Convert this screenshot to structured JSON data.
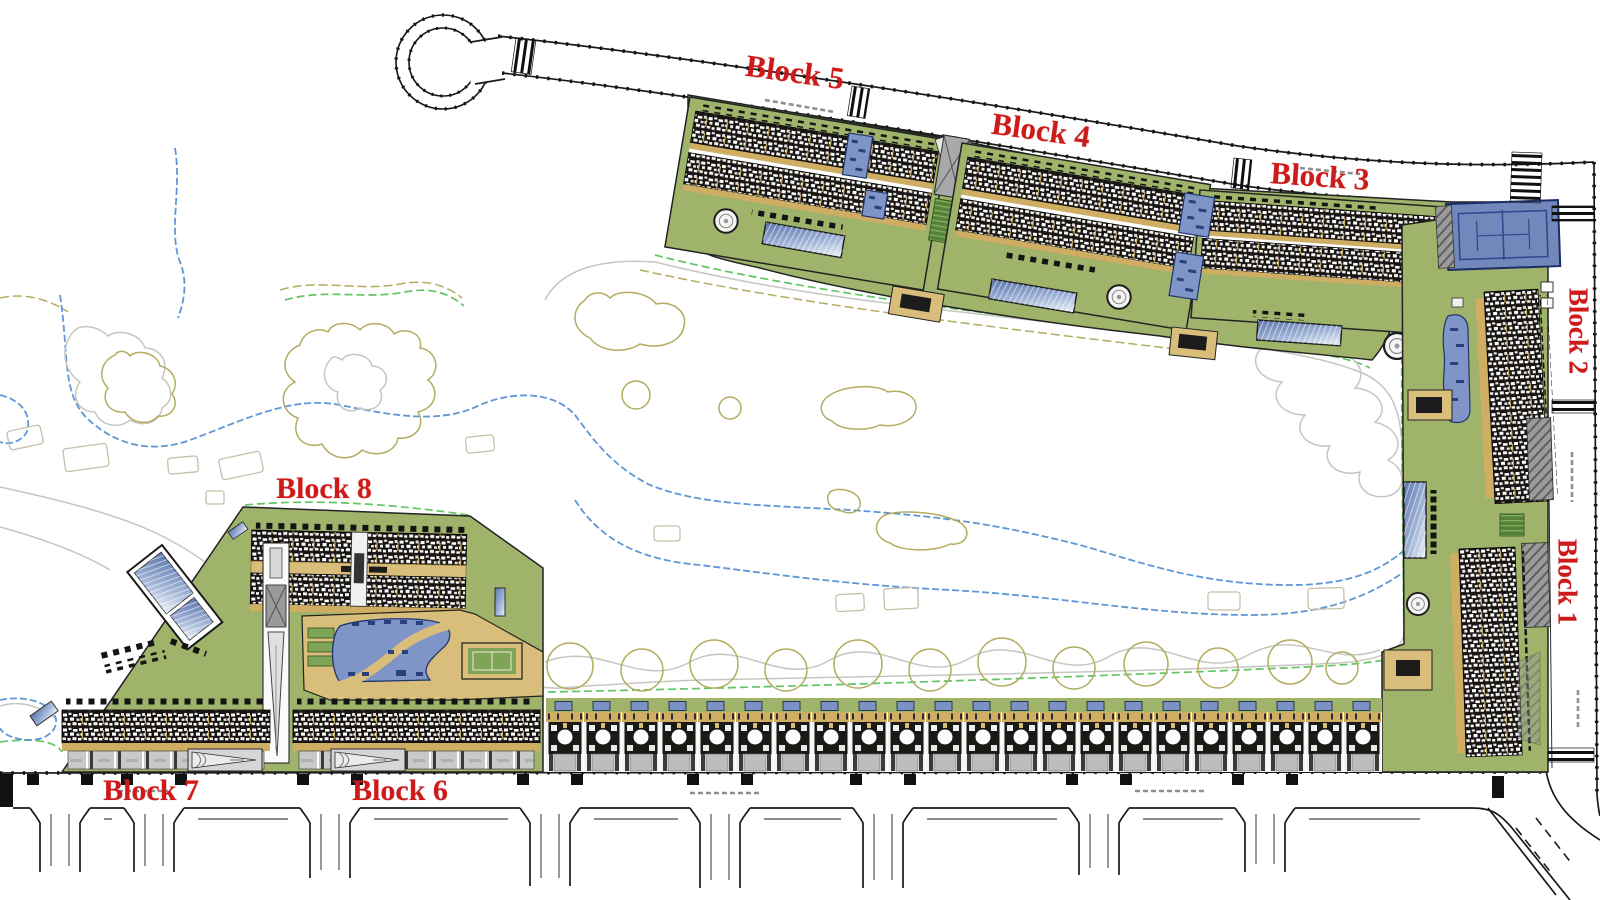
{
  "plan": {
    "type": "residential-resort-site-plan",
    "labels": [
      {
        "id": "block-5",
        "text": "Block 5"
      },
      {
        "id": "block-4",
        "text": "Block 4"
      },
      {
        "id": "block-3",
        "text": "Block 3"
      },
      {
        "id": "block-2",
        "text": "Block 2"
      },
      {
        "id": "block-1",
        "text": "Block 1"
      },
      {
        "id": "block-8",
        "text": "Block 8"
      },
      {
        "id": "block-7",
        "text": "Block 7"
      },
      {
        "id": "block-6",
        "text": "Block 6"
      }
    ],
    "colors": {
      "label_red": "#cd1a1a",
      "parcel_green": "#9fb36a",
      "lawn_green_dark": "#7da457",
      "sand_tan": "#d9bd7a",
      "path_tan": "#cfae63",
      "pool_blue": "#8095c7",
      "tennis_blue": "#7287ba",
      "court_line_blue": "#2e4a8f",
      "glass_blue": "#9fb3d6",
      "roof_dark": "#181512",
      "paving_gray": "#c9c9c9",
      "structure_gray": "#a8a8a8",
      "road_line_black": "#1a1a1a",
      "contour_olive": "#b3ab60",
      "contour_gray": "#c6c6c0",
      "contour_blue": "#5f97d6",
      "contour_green": "#62c462"
    }
  }
}
